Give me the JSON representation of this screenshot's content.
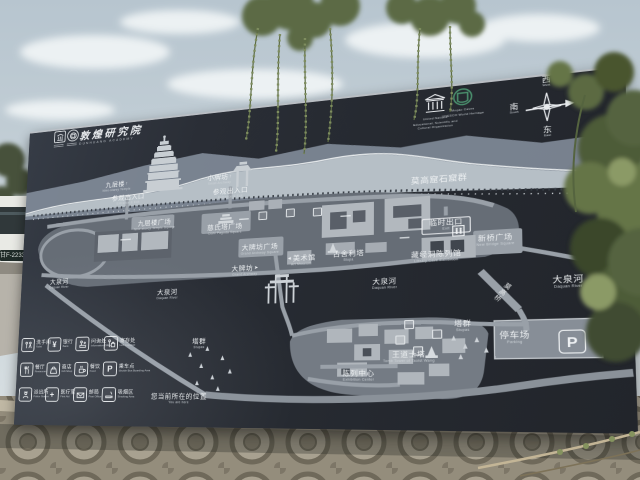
{
  "scene": {
    "bus_sign": "甘F-2233"
  },
  "board": {
    "title": {
      "zh": "敦煌研究院",
      "en": "DUNHUANG ACADEMY"
    },
    "logos": {
      "unesco_caption": [
        "United Nations",
        "Educational, Scientific and",
        "Cultural Organization"
      ],
      "heritage_caption": [
        "Mogao Caves",
        "UNESCO World Heritage"
      ]
    },
    "compass": {
      "west": {
        "zh": "西",
        "en": "West"
      },
      "south": {
        "zh": "南",
        "en": "South"
      },
      "north": {
        "zh": "北",
        "en": "North"
      },
      "east": {
        "zh": "东",
        "en": "East"
      }
    },
    "map_labels": {
      "caves_group": {
        "zh": "莫高窟石窟群"
      },
      "nine_storey": {
        "zh": "九层楼",
        "arrow": "↑",
        "en": "Nine-storey Temple"
      },
      "entrance": {
        "zh": "参观出入口",
        "en": "Entrance & Exit"
      },
      "small_archway": {
        "zh": "小牌坊",
        "arrow": "↑",
        "en": "Small Archway"
      },
      "temp_exit": {
        "zh": "临时出口",
        "en": "Exit"
      },
      "new_bridge_square": {
        "zh": "新桥广场",
        "en": "New Bridge Square"
      },
      "library_cave": {
        "zh": "藏经洞陈列馆",
        "en": "Library Cave Exhibition"
      },
      "nine_storey_square": {
        "zh": "九层楼广场",
        "en": "Nine-storey Temple Square"
      },
      "cishi_square": {
        "zh": "慈氏塔广场",
        "en": "Cishi Pagoda Square"
      },
      "archway_square": {
        "zh": "大牌坊广场",
        "en": "Grand Archway Square"
      },
      "grand_archway": {
        "zh": "大牌坊",
        "arrow": "➤",
        "en": "Grand Archway"
      },
      "art_museum": {
        "arrow": "◄",
        "zh": "美术馆",
        "en": "Art Museum"
      },
      "ancient_stupa": {
        "zh": "古舍利塔",
        "en": "Stupa"
      },
      "daquan_river": {
        "zh": "大泉河",
        "en": "Daquan River"
      },
      "mogao_bridge": {
        "zh": "莫高桥"
      },
      "stupa_group": {
        "zh": "塔群",
        "en": "Stupas"
      },
      "wang_tower": {
        "zh": "王道士塔",
        "en": "Tomb Tower of Taoist Wang"
      },
      "parking": {
        "zh": "停车场",
        "en": "Parking",
        "glyph": "P"
      },
      "exhibition_center": {
        "zh": "陈列中心",
        "en": "Exhibition Center"
      },
      "you_are_here": {
        "zh": "您当前所在的位置",
        "en": "You are here"
      }
    },
    "legend": {
      "items": [
        {
          "zh": "洗手间",
          "en": "Toilet",
          "icon": "toilet"
        },
        {
          "zh": "银行",
          "en": "Bank",
          "icon": "bank",
          "glyph": "¥"
        },
        {
          "zh": "问询处",
          "en": "Information Office",
          "icon": "information"
        },
        {
          "zh": "寄存处",
          "en": "Left Luggage",
          "icon": "left-luggage"
        },
        {
          "zh": "餐厅",
          "en": "Restaurant",
          "icon": "restaurant"
        },
        {
          "zh": "商店",
          "en": "Gift Shop",
          "icon": "gift-shop"
        },
        {
          "zh": "餐饮",
          "en": "Food",
          "icon": "food"
        },
        {
          "zh": "乘车点",
          "en": "Shuttle Bus Boarding Area",
          "icon": "shuttle",
          "glyph": "P"
        },
        {
          "zh": "派出所",
          "en": "Police Station",
          "icon": "police"
        },
        {
          "zh": "医疗室",
          "en": "First Aid",
          "icon": "first-aid",
          "glyph": "+"
        },
        {
          "zh": "邮局",
          "en": "Post Office",
          "icon": "post-office"
        },
        {
          "zh": "吸烟区",
          "en": "Smoking Area",
          "icon": "smoking"
        }
      ]
    }
  },
  "colors": {
    "board": "#272b32",
    "map_ground": "#666d76",
    "road": "#99a0a8",
    "building": "#b0b6bc",
    "ridge_front": "#b6bfc6",
    "ridge_back": "#8792a0",
    "text": "#f0f2f4",
    "heritage_green": "#4a8f6d",
    "sky": "#c3ced6",
    "foliage": "#5c6b42",
    "stone": "#978f7d"
  }
}
